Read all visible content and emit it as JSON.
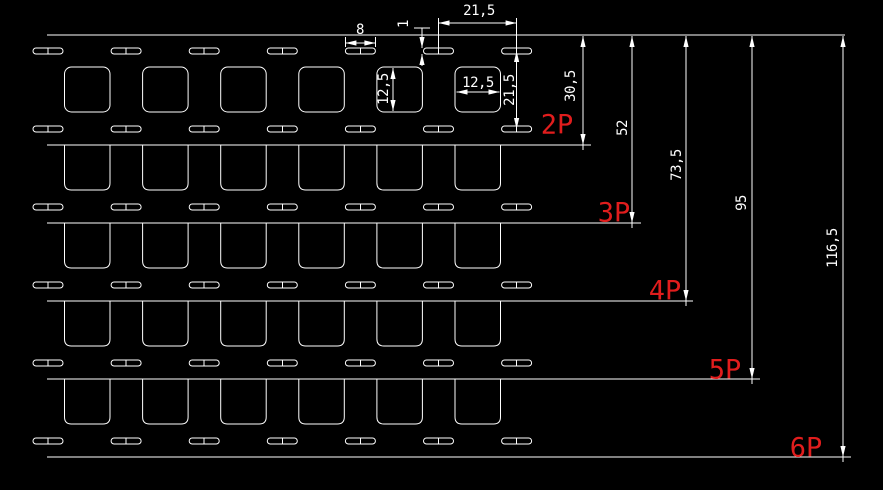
{
  "colors": {
    "background": "#000000",
    "line": "#ffffff",
    "accent": "#e11d1d"
  },
  "dims": {
    "slot_pitch": "21,5",
    "slot_width": "8",
    "slot_thickness": "1",
    "square_height": "12,5",
    "square_width": "12,5",
    "row_pitch": "21,5",
    "len_2p": "30,5",
    "len_3p": "52",
    "len_4p": "73,5",
    "len_5p": "95",
    "len_6p": "116,5"
  },
  "labels": {
    "p2": "2P",
    "p3": "3P",
    "p4": "4P",
    "p5": "5P",
    "p6": "6P"
  },
  "geometry": {
    "cut_lines": [
      {
        "y": 35,
        "x1": 47,
        "x2": 845
      },
      {
        "y": 145,
        "x1": 47,
        "x2": 591
      },
      {
        "y": 223,
        "x1": 47,
        "x2": 641
      },
      {
        "y": 301,
        "x1": 47,
        "x2": 693
      },
      {
        "y": 379,
        "x1": 47,
        "x2": 760
      },
      {
        "y": 457,
        "x1": 47,
        "x2": 851
      }
    ],
    "slots": {
      "rows_y": [
        48,
        126,
        204,
        282,
        360,
        438
      ],
      "x0": 33,
      "pitch": 78.1,
      "count": 7,
      "w": 30,
      "h": 6,
      "r": 3
    },
    "squares": {
      "x0": 64.5,
      "pitch": 78.1,
      "count": 6,
      "w": 45.5,
      "h": 45,
      "r": 7,
      "free_y": 67,
      "attached_cuts": [
        145,
        223,
        301,
        379
      ]
    },
    "vdims": [
      {
        "x": 583,
        "cut": 145
      },
      {
        "x": 632,
        "cut": 223
      },
      {
        "x": 686,
        "cut": 301
      },
      {
        "x": 752,
        "cut": 379
      },
      {
        "x": 843,
        "cut": 457
      }
    ],
    "lines": [
      [
        438.5,
        18,
        438.5,
        53
      ],
      [
        516.6,
        18,
        516.6,
        131
      ],
      [
        438.5,
        23,
        516.6,
        23
      ],
      [
        345.4,
        37,
        345.4,
        47
      ],
      [
        375.4,
        37,
        375.4,
        47
      ],
      [
        345.4,
        43,
        375.4,
        43
      ],
      [
        414,
        28,
        430,
        28
      ],
      [
        422,
        28,
        422,
        48
      ],
      [
        422,
        54,
        422,
        66
      ],
      [
        393,
        68,
        393,
        111
      ],
      [
        456.5,
        92,
        499.5,
        92
      ]
    ],
    "arrows": [
      [
        438.5,
        23,
        "left"
      ],
      [
        516.6,
        23,
        "right"
      ],
      [
        345.4,
        43,
        "left"
      ],
      [
        375.4,
        43,
        "right"
      ],
      [
        422,
        48,
        "down"
      ],
      [
        422,
        54,
        "up"
      ],
      [
        516.6,
        51,
        "up"
      ],
      [
        516.6,
        129,
        "down"
      ],
      [
        393,
        68,
        "up"
      ],
      [
        393,
        111,
        "down"
      ],
      [
        456.5,
        92,
        "left"
      ],
      [
        499.5,
        92,
        "right"
      ]
    ]
  }
}
